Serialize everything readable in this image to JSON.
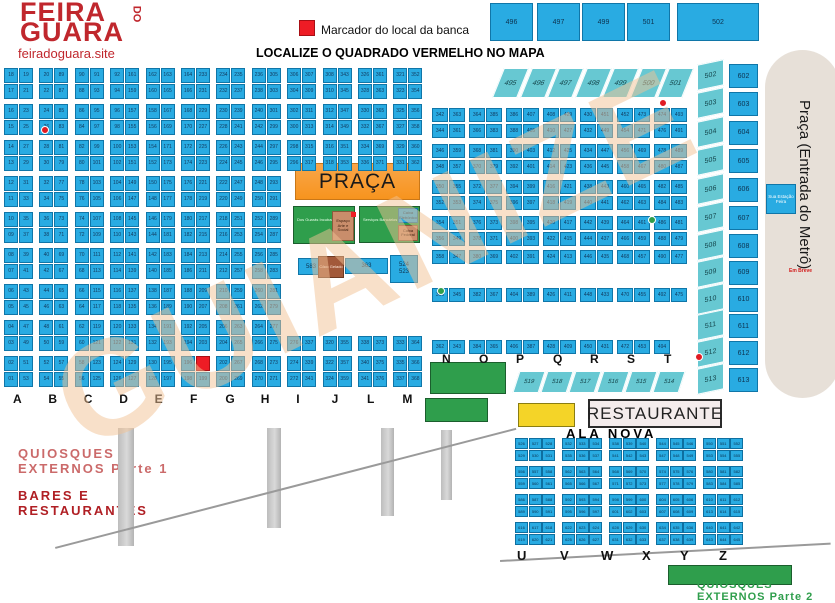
{
  "header": {
    "logo_line1": "FEIRA",
    "logo_line2": "GUARA",
    "logo_do": "DO",
    "site": "feiradoguara.site",
    "legend_label": "Marcador do local da banca",
    "headline": "LOCALIZE O QUADRADO VERMELHO NO MAPA"
  },
  "colors": {
    "stall_blue": "#29abe2",
    "teal": "#67c8d2",
    "marker_red": "#ee1c25",
    "praca_orange": "#f7941e",
    "green": "#2f9e4c",
    "yellow": "#f4d428",
    "brand_red": "#c0272d",
    "metro_beige": "#e7e0d8"
  },
  "watermark_text": "GUIANIZE",
  "top_blocks": [
    "496",
    "497",
    "499",
    "501",
    "502"
  ],
  "diag_row": [
    "495",
    "496",
    "497",
    "498",
    "499",
    "500",
    "501"
  ],
  "right_teal_column": [
    "502",
    "503",
    "504",
    "505",
    "506",
    "507",
    "508",
    "509",
    "510",
    "511",
    "512",
    "513"
  ],
  "right_blue_column": [
    "602",
    "603",
    "604",
    "605",
    "606",
    "607",
    "608",
    "609",
    "610",
    "611",
    "612",
    "613"
  ],
  "teal_row": [
    "519",
    "518",
    "517",
    "516",
    "515",
    "514"
  ],
  "marker_cell": {
    "column": "F",
    "row": 16,
    "covered_stall": "201"
  },
  "left_grid": {
    "columns": [
      {
        "letter": "A",
        "pairs": [
          "18|19",
          "17|21",
          "16|23",
          "15|25",
          "14|27",
          "13|29",
          "12|31",
          "11|33",
          "10|35",
          "09|37",
          "08|39",
          "07|41",
          "06|43",
          "05|45",
          "04|47",
          "03|49",
          "02|51",
          "01|53"
        ]
      },
      {
        "letter": "B",
        "pairs": [
          "20|89",
          "22|87",
          "24|85",
          "26|83",
          "28|81",
          "30|79",
          "32|77",
          "34|75",
          "36|73",
          "38|71",
          "40|69",
          "42|67",
          "44|65",
          "46|63",
          "48|61",
          "50|59",
          "52|57",
          "54|55"
        ]
      },
      {
        "letter": "C",
        "pairs": [
          "90|91",
          "88|93",
          "86|95",
          "84|97",
          "82|99",
          "80|101",
          "78|103",
          "76|105",
          "74|107",
          "72|109",
          "70|111",
          "68|113",
          "66|115",
          "64|117",
          "62|119",
          "60|121",
          "58|123",
          "56|125"
        ]
      },
      {
        "letter": "D",
        "pairs": [
          "92|161",
          "94|159",
          "96|157",
          "98|155",
          "100|153",
          "102|151",
          "104|149",
          "106|147",
          "108|145",
          "110|143",
          "112|141",
          "114|139",
          "116|137",
          "118|135",
          "120|133",
          "122|131",
          "124|129",
          "126|127"
        ]
      },
      {
        "letter": "E",
        "pairs": [
          "162|163",
          "160|165",
          "158|167",
          "156|169",
          "154|171",
          "152|173",
          "150|175",
          "148|177",
          "146|179",
          "144|181",
          "142|183",
          "140|185",
          "138|187",
          "136|189",
          "134|191",
          "132|193",
          "130|195",
          "128|197"
        ]
      },
      {
        "letter": "F",
        "pairs": [
          "164|233",
          "166|231",
          "168|229",
          "170|227",
          "172|225",
          "174|223",
          "176|221",
          "178|219",
          "180|217",
          "182|215",
          "184|213",
          "186|211",
          "188|209",
          "190|207",
          "192|205",
          "194|203",
          "196|201",
          "198|199"
        ]
      },
      {
        "letter": "G",
        "pairs": [
          "234|235",
          "232|237",
          "230|239",
          "228|241",
          "226|243",
          "224|245",
          "222|247",
          "220|249",
          "218|251",
          "216|253",
          "214|255",
          "212|257",
          "210|259",
          "208|261",
          "206|263",
          "204|265",
          "202|267",
          "200|269"
        ]
      },
      {
        "letter": "H",
        "pairs": [
          "236|305",
          "238|303",
          "240|301",
          "242|299",
          "244|297",
          "246|295",
          "248|293",
          "250|291",
          "252|289",
          "254|287",
          "256|285",
          "258|283",
          "260|281",
          "262|279",
          "264|277",
          "266|275",
          "268|273",
          "270|271"
        ]
      },
      {
        "letter": "I",
        "top": [
          "306|307",
          "304|309",
          "302|311",
          "300|313",
          "298|315",
          "296|317"
        ],
        "bottom": [
          "276|337",
          "274|339",
          "272|341"
        ]
      },
      {
        "letter": "J",
        "top": [
          "308|343",
          "310|345",
          "312|347",
          "314|349",
          "316|351",
          "318|353"
        ],
        "bottom": [
          "320|355",
          "322|357",
          "324|359"
        ]
      },
      {
        "letter": "L",
        "top": [
          "326|361",
          "328|363",
          "330|365",
          "332|367",
          "334|369",
          "336|371"
        ],
        "bottom": [
          "338|373",
          "340|375",
          "341|376"
        ]
      },
      {
        "letter": "M",
        "top": [
          "321|352",
          "323|354",
          "325|356",
          "327|358",
          "329|360",
          "331|362"
        ],
        "bottom": [
          "333|364",
          "335|366",
          "337|368"
        ]
      }
    ]
  },
  "right_grid": {
    "columns": [
      {
        "letter": "N",
        "pairs": [
          "342|363",
          "344|361",
          "346|359",
          "348|357",
          "350|355",
          "352|353",
          "354|351",
          "356|349",
          "358|347",
          "360|345",
          "362|343"
        ]
      },
      {
        "letter": "O",
        "pairs": [
          "364|385",
          "366|383",
          "368|381",
          "370|379",
          "372|377",
          "374|375",
          "376|373",
          "378|371",
          "380|369",
          "382|367",
          "384|365"
        ]
      },
      {
        "letter": "P",
        "pairs": [
          "386|407",
          "388|405",
          "390|403",
          "392|401",
          "394|399",
          "396|397",
          "398|395",
          "400|393",
          "402|391",
          "404|389",
          "406|387"
        ]
      },
      {
        "letter": "Q",
        "pairs": [
          "408|429",
          "410|427",
          "412|425",
          "414|423",
          "416|421",
          "418|419",
          "420|417",
          "422|415",
          "424|413",
          "426|411",
          "428|409"
        ]
      },
      {
        "letter": "R",
        "pairs": [
          "430|451",
          "432|449",
          "434|447",
          "436|445",
          "438|443",
          "440|441",
          "442|439",
          "444|437",
          "446|435",
          "448|433",
          "450|431"
        ]
      },
      {
        "letter": "S",
        "pairs": [
          "452|473",
          "454|471",
          "456|469",
          "458|467",
          "460|465",
          "462|463",
          "464|461",
          "466|459",
          "468|457",
          "470|455",
          "472|453"
        ]
      },
      {
        "letter": "T",
        "pairs": [
          "474|493",
          "476|491",
          "478|489",
          "480|487",
          "482|485",
          "484|483",
          "486|481",
          "488|479",
          "490|477",
          "492|475",
          "494|"
        ]
      }
    ]
  },
  "praca": {
    "title": "PRAÇA",
    "green_left_text": "Dos Guarás Incubadora",
    "tan_left_text": "Espaço Arte e Social",
    "green_right_text": "Serviços Bancários",
    "blue_inset_text": "Caixa Eletrônico",
    "tan_inset_text": "Caixa Federal",
    "small_blue_1": "583",
    "brown_text": "Côco Gelado",
    "small_blue_2": "363",
    "big_blue_top": "524",
    "big_blue_bottom": "523"
  },
  "sections": {
    "restaurante": "RESTAURANTE",
    "ala_nova": "ALA NOVA",
    "quiosques1_line1": "QUIOSQUES",
    "quiosques1_line2": "EXTERNOS Parte 1",
    "bares_line1": "BARES E",
    "bares_line2": "RESTAURANTES",
    "quiosques2_line1": "QUIOSQUES",
    "quiosques2_line2": "EXTERNOS Parte 2"
  },
  "ala_nova_grid": {
    "letters": [
      "U",
      "V",
      "W",
      "X",
      "Y",
      "Z"
    ],
    "blocks": [
      [
        "526",
        "527",
        "528",
        "529",
        "530",
        "531"
      ],
      [
        "532",
        "533",
        "534",
        "535",
        "536",
        "537"
      ],
      [
        "538",
        "539",
        "540",
        "541",
        "542",
        "543"
      ],
      [
        "544",
        "545",
        "546",
        "547",
        "548",
        "549"
      ],
      [
        "550",
        "551",
        "552",
        "553",
        "554",
        "555"
      ],
      [
        "556",
        "557",
        "558",
        "559",
        "560",
        "561"
      ],
      [
        "562",
        "563",
        "564",
        "565",
        "566",
        "567"
      ],
      [
        "568",
        "569",
        "570",
        "571",
        "572",
        "573"
      ],
      [
        "574",
        "575",
        "576",
        "577",
        "578",
        "579"
      ],
      [
        "580",
        "581",
        "582",
        "583",
        "584",
        "585"
      ],
      [
        "586",
        "587",
        "588",
        "589",
        "590",
        "591"
      ],
      [
        "592",
        "593",
        "594",
        "595",
        "596",
        "597"
      ],
      [
        "598",
        "599",
        "600",
        "601",
        "602",
        "603"
      ],
      [
        "604",
        "605",
        "606",
        "607",
        "608",
        "609"
      ],
      [
        "610",
        "611",
        "612",
        "613",
        "614",
        "615"
      ],
      [
        "616",
        "617",
        "618",
        "619",
        "620",
        "621"
      ],
      [
        "622",
        "623",
        "624",
        "625",
        "626",
        "627"
      ],
      [
        "628",
        "629",
        "630",
        "631",
        "632",
        "633"
      ],
      [
        "634",
        "635",
        "636",
        "637",
        "638",
        "639"
      ],
      [
        "640",
        "641",
        "642",
        "643",
        "644",
        "645"
      ]
    ]
  },
  "metro": {
    "label": "Praça (Entrada do Metrô)",
    "station_box": "Sua Estação Feira",
    "soon": "Em Breve"
  },
  "marker_dots": {
    "red": [
      [
        41,
        126
      ],
      [
        659,
        99
      ],
      [
        695,
        353
      ]
    ],
    "green": [
      [
        648,
        216
      ],
      [
        437,
        287
      ]
    ]
  }
}
